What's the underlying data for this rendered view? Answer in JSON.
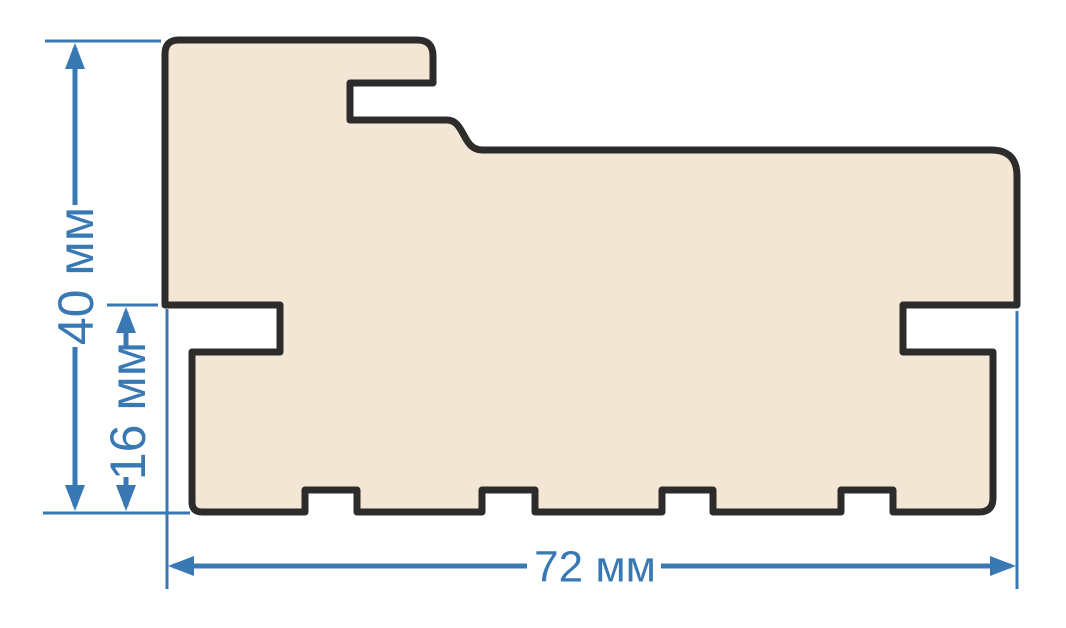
{
  "colors": {
    "dimension-blue": "#3878b3",
    "profile-fill": "#f3e6d4",
    "profile-outline": "#2d2c2a",
    "background": "#ffffff"
  },
  "diagram": {
    "unit": "мм",
    "dimensions": {
      "total_height": {
        "label": "40 мм",
        "value": 40,
        "orientation": "vertical"
      },
      "lower_height": {
        "label": "16 мм",
        "value": 16,
        "orientation": "vertical"
      },
      "total_width": {
        "label": "72 мм",
        "value": 72,
        "orientation": "horizontal"
      }
    }
  }
}
